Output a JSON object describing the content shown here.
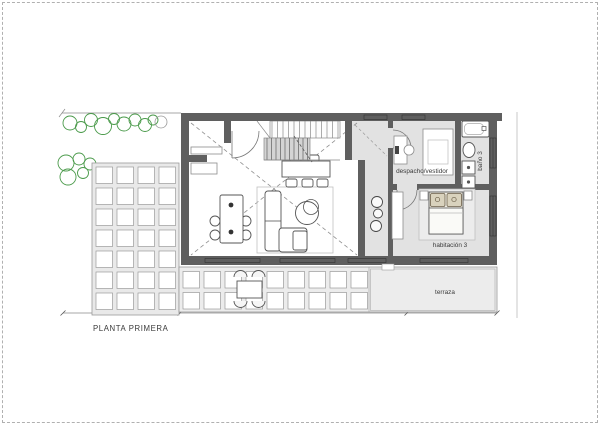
{
  "plan": {
    "caption": "PLANTA PRIMERA",
    "rooms": {
      "study": {
        "label": "despacho/vestidor"
      },
      "bath": {
        "label": "baño 3"
      },
      "bedroom": {
        "label": "habitación 3"
      },
      "terrace": {
        "label": "terraza"
      }
    },
    "palette": {
      "wall": "#5f5f5f",
      "room_floor": "#e2e2e2",
      "paving_background": "#e9e9e9",
      "tree_green": "#4a9a4a",
      "drawing_line": "#8a8a8a",
      "text": "#3a3a3a",
      "sheet_border_dash": "#b0b0b0"
    }
  }
}
